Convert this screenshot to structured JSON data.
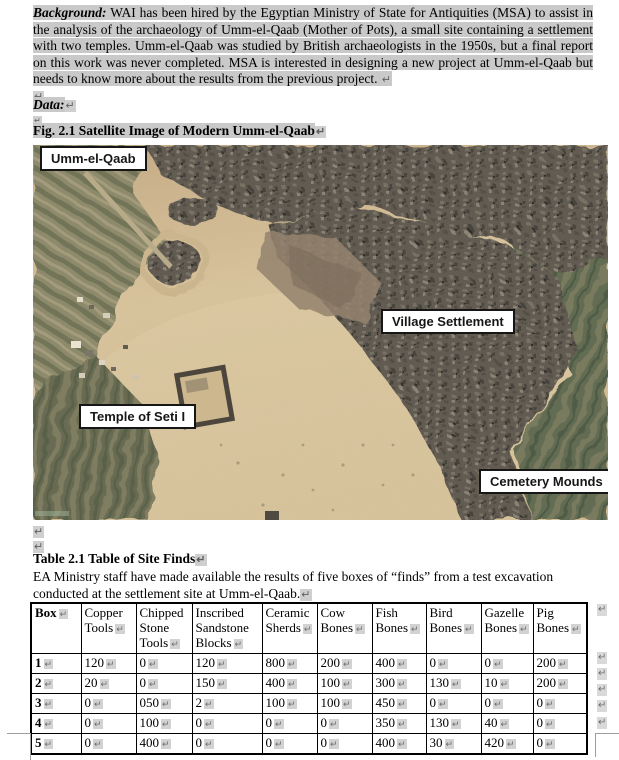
{
  "marks": {
    "pilcrow": "↵"
  },
  "colors": {
    "highlight": "#c9c9c9",
    "table_border": "#000000",
    "label_background": "#ffffff",
    "label_border": "#161616",
    "sand": "#d5bf97",
    "fields_green": "#6e7257",
    "urban_dark": "#5d574e",
    "mark_gray": "#6e6e6e"
  },
  "background_paragraph": {
    "lead": "Background:",
    "body": " WAI has been hired by the Egyptian Ministry of State for Antiquities (MSA) to assist in the analysis of the archaeology of Umm-el-Qaab (Mother of Pots), a small site containing a settlement with two temples. Umm-el-Qaab was studied by British archaeologists in the 1950s, but a final report on this work was never completed. MSA is interested in designing a new project at Umm-el-Qaab but needs to know more about the results from the previous project. "
  },
  "data_label": "Data:",
  "figure": {
    "caption": "Fig. 2.1 Satellite Image of Modern Umm-el-Qaab",
    "labels": [
      "Umm-el-Qaab",
      "Village Settlement",
      "Temple of Seti I",
      "Cemetery Mounds"
    ]
  },
  "table_section": {
    "caption": "Table 2.1 Table of Site Finds",
    "intro": "EA Ministry staff have made available the results of five boxes of “finds” from a test excavation conducted at the settlement site at Umm-el-Qaab."
  },
  "table": {
    "headers": [
      "Box",
      "Copper Tools",
      "Chipped Stone Tools",
      "Inscribed Sandstone Blocks",
      "Ceramic Sherds",
      "Cow Bones",
      "Fish Bones",
      "Bird Bones",
      "Gazelle Bones",
      "Pig Bones"
    ],
    "rows": [
      [
        "1",
        "120",
        "0",
        "120",
        "800",
        "200",
        "400",
        "0",
        "0",
        "200"
      ],
      [
        "2",
        "20",
        "0",
        "150",
        "400",
        "100",
        "300",
        "130",
        "10",
        "200"
      ],
      [
        "3",
        "0",
        "050",
        "2",
        "100",
        "100",
        "450",
        "0",
        "0",
        "0"
      ],
      [
        "4",
        "0",
        "100",
        "0",
        "0",
        "0",
        "350",
        "130",
        "40",
        "0"
      ],
      [
        "5",
        "0",
        "400",
        "0",
        "0",
        "0",
        "400",
        "30",
        "420",
        "0"
      ]
    ]
  }
}
